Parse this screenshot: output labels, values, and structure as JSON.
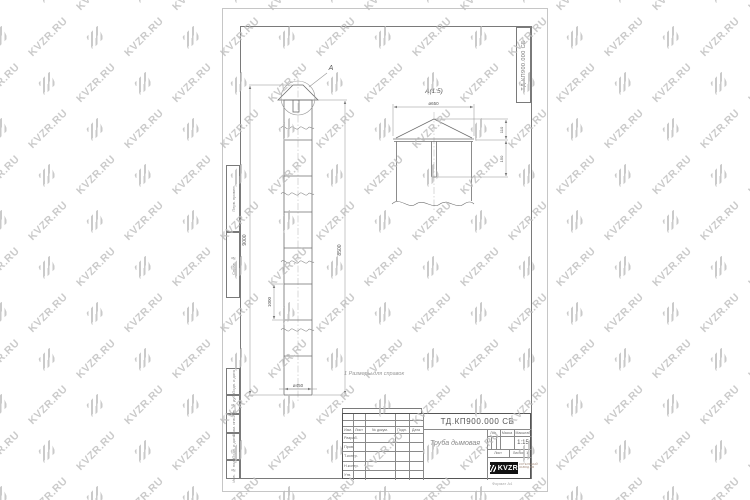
{
  "watermark": {
    "text": "KVZR.RU"
  },
  "sheet": {
    "code_vertical": "ТД.КП900.000 СБ",
    "margin_labels_top": [
      "Перв. примен.",
      "Справ. №"
    ],
    "margin_labels_bottom": [
      "Подп. и дата",
      "Инв. № дубл.",
      "Взам. инв. №",
      "Подп. и дата",
      "Инв. № подл."
    ],
    "note": "1 Размеры для справок",
    "format_label": "Формат А4"
  },
  "drawing": {
    "callout_label": "А",
    "detail_label": "А(1:5)",
    "detail_diameter": "ø650",
    "detail_dim_top": "110",
    "detail_dim_bottom": "150",
    "dim_total_height": "9000",
    "dim_body_height": "8500",
    "dim_segment": "1000",
    "dim_diameter": "ø450"
  },
  "title_block": {
    "code": "ТД.КП900.000 СБ",
    "part_name": "Труба дымовая",
    "header_cols": [
      "Изм.",
      "Лист",
      "№ докум.",
      "Подп.",
      "Дата"
    ],
    "signature_rows": [
      "Разраб.",
      "Пров.",
      "Т.контр.",
      "Н.контр.",
      "Утв."
    ],
    "lit_label": "Лит.",
    "mass_label": "Масса",
    "scale_label": "Масштаб",
    "scale_value": "1:15",
    "sheet_label": "Лист",
    "sheets_label": "Листов",
    "sheets_value": "1",
    "logo_text": "KVZR",
    "logo_caption": [
      "КОТЕЛЬНЫЙ",
      "ЗАВОД.РФ"
    ]
  }
}
